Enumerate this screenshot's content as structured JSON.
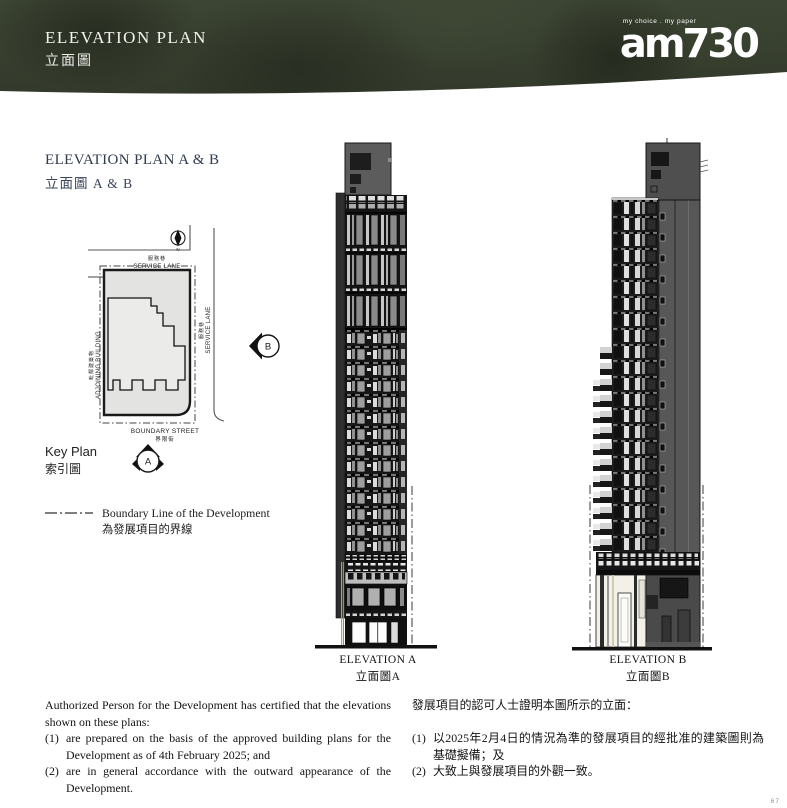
{
  "header": {
    "title_en": "ELEVATION PLAN",
    "title_zh": "立面圖",
    "logo_text": "am730",
    "logo_tagline": "my choice . my paper"
  },
  "section": {
    "heading_en": "ELEVATION PLAN A & B",
    "heading_zh": "立面圖 A & B"
  },
  "key_plan": {
    "label_en": "Key Plan",
    "label_zh": "索引圖",
    "north_label": "N",
    "service_lane_top": {
      "zh": "服務巷",
      "en": "SERVICE LANE"
    },
    "service_lane_right": {
      "zh": "服務巷",
      "en": "SERVICE LANE"
    },
    "adjoining_building": {
      "zh": "毗鄰建築物",
      "en": "ADJOINING BUILDING"
    },
    "boundary_street": {
      "en": "BOUNDARY STREET",
      "zh": "界限街"
    },
    "marker_a": "A",
    "marker_b": "B"
  },
  "legend": {
    "boundary_line_en": "Boundary Line of the Development",
    "boundary_line_zh": "為發展項目的界線"
  },
  "elevations": [
    {
      "caption_en": "ELEVATION A",
      "caption_zh": "立面圖A"
    },
    {
      "caption_en": "ELEVATION B",
      "caption_zh": "立面圖B"
    }
  ],
  "notes_en": {
    "intro": "Authorized Person for the Development has certified that the elevations shown on these plans:",
    "items": [
      {
        "num": "(1)",
        "text": "are prepared on the basis of the approved building plans for the Development as of 4th February 2025; and"
      },
      {
        "num": "(2)",
        "text": "are in general accordance with the outward appearance of the Development."
      }
    ]
  },
  "notes_zh": {
    "intro": "發展項目的認可人士證明本圖所示的立面：",
    "items": [
      {
        "num": "(1)",
        "text": "以2025年2月4日的情況為準的發展項目的經批准的建築圖則為基礎擬備；及"
      },
      {
        "num": "(2)",
        "text": "大致上與發展項目的外觀一致。"
      }
    ]
  },
  "page_number": "67",
  "colors": {
    "header_bg": "#39412f",
    "heading_text": "#2f3a4d",
    "body_text": "#1c1c1c"
  }
}
